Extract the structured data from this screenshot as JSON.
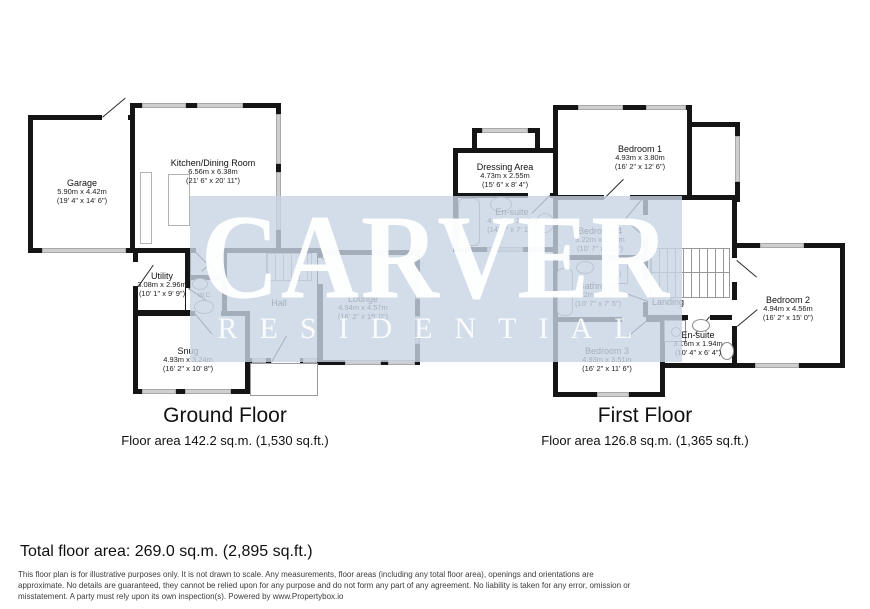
{
  "watermark": {
    "line1": "CARVER",
    "line2": "RESIDENTIAL"
  },
  "ground_floor": {
    "title": "Ground Floor",
    "area": "Floor area 142.2 sq.m. (1,530 sq.ft.)",
    "rooms": [
      {
        "name": "Garage",
        "metric": "5.90m x 4.42m",
        "imperial": "(19' 4\" x 14' 6\")"
      },
      {
        "name": "Kitchen/Dining Room",
        "metric": "6.56m x 6.38m",
        "imperial": "(21' 6\" x 20' 11\")"
      },
      {
        "name": "Utility",
        "metric": "3.08m x 2.96m",
        "imperial": "(10' 1\" x 9' 9\")"
      },
      {
        "name": "W.C."
      },
      {
        "name": "Hall"
      },
      {
        "name": "Lounge",
        "metric": "4.94m x 4.57m",
        "imperial": "(16' 2\" x 15' 0\")"
      },
      {
        "name": "Snug",
        "metric": "4.93m x 3.24m",
        "imperial": "(16' 2\" x 10' 8\")"
      }
    ]
  },
  "first_floor": {
    "title": "First Floor",
    "area": "Floor area 126.8 sq.m. (1,365 sq.ft.)",
    "rooms": [
      {
        "name": "Dressing Area",
        "metric": "4.73m x 2.55m",
        "imperial": "(15' 6\" x 8' 4\")"
      },
      {
        "name": "Bedroom 1",
        "metric": "4.93m x 3.80m",
        "imperial": "(16' 2\" x 12' 6\")"
      },
      {
        "name": "En-suite",
        "metric": "4.34m x 2.42m",
        "imperial": "(14' 3\" x 7' 11\")"
      },
      {
        "name": "Bedroom 4",
        "metric": "3.22m x 2.47m",
        "imperial": "(10' 7\" x 8' 1\")"
      },
      {
        "name": "Bathroom",
        "metric": "3.22m x 2.27m",
        "imperial": "(10' 7\" x 7' 5\")"
      },
      {
        "name": "Landing"
      },
      {
        "name": "Bedroom 2",
        "metric": "4.94m x 4.56m",
        "imperial": "(16' 2\" x 15' 0\")"
      },
      {
        "name": "Bedroom 3",
        "metric": "4.93m x 3.51m",
        "imperial": "(16' 2\" x 11' 6\")"
      },
      {
        "name": "En-suite",
        "metric": "3.16m x 1.94m",
        "imperial": "(10' 4\" x 6' 4\")"
      }
    ]
  },
  "summary": {
    "total": "Total floor area: 269.0 sq.m. (2,895 sq.ft.)"
  },
  "disclaimer": {
    "line1": "This floor plan is for illustrative purposes only. It is not drawn to scale. Any measurements, floor areas (including any total floor area), openings and orientations are",
    "line2": "approximate. No details are guaranteed, they cannot be relied upon for any purpose and do not form any part of any agreement. No liability is taken for any error, omission or",
    "line3": "misstatement. A party must rely upon its own inspection(s). Powered by www.Propertybox.io"
  },
  "colors": {
    "wall": "#151515",
    "window": "#cfcfcf",
    "watermark_band": "#c8d4e3",
    "watermark_text": "#ffffff"
  }
}
